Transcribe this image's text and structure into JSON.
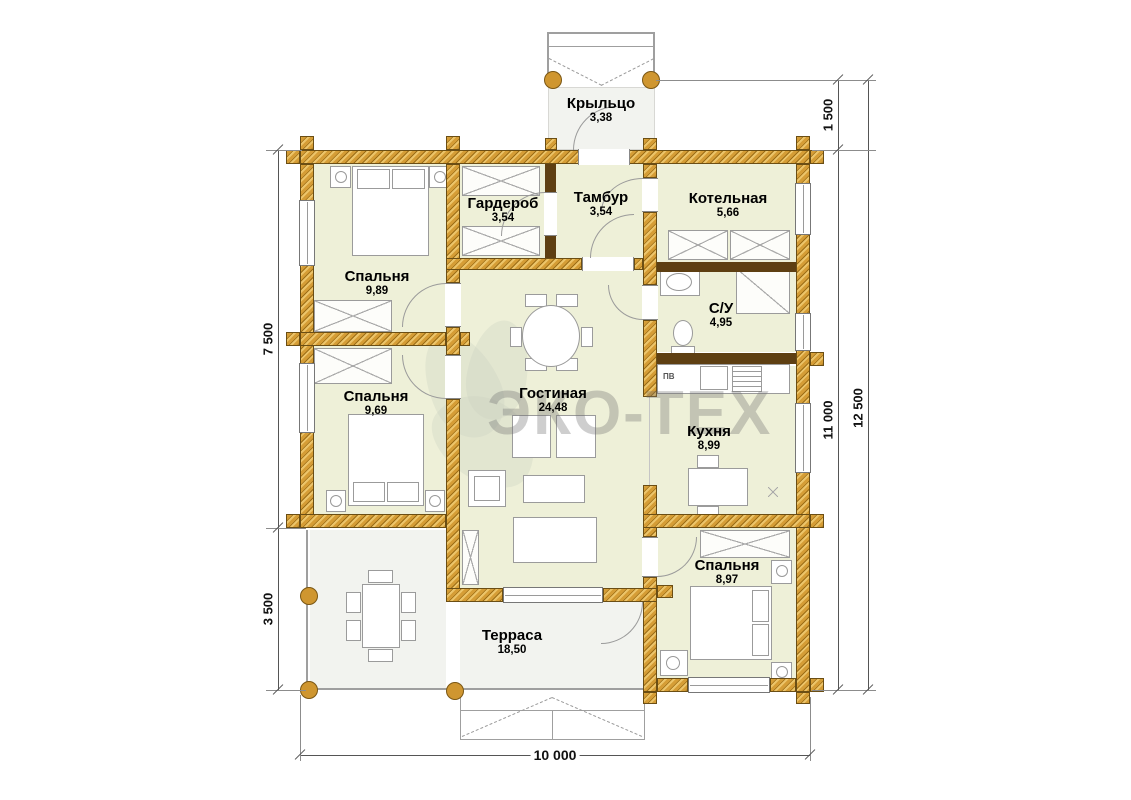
{
  "watermark": {
    "text": "ЭКО-ТЕХ"
  },
  "rooms": {
    "porch": {
      "name": "Крыльцо",
      "area": "3,38"
    },
    "wardrobe": {
      "name": "Гардероб",
      "area": "3,54"
    },
    "vestibule": {
      "name": "Тамбур",
      "area": "3,54"
    },
    "boiler": {
      "name": "Котельная",
      "area": "5,66"
    },
    "bedroom1": {
      "name": "Спальня",
      "area": "9,89"
    },
    "bathroom": {
      "name": "С/У",
      "area": "4,95"
    },
    "bedroom2": {
      "name": "Спальня",
      "area": "9,69"
    },
    "living": {
      "name": "Гостиная",
      "area": "24,48"
    },
    "kitchen": {
      "name": "Кухня",
      "area": "8,99"
    },
    "bedroom3": {
      "name": "Спальня",
      "area": "8,97"
    },
    "terrace": {
      "name": "Терраса",
      "area": "18,50"
    }
  },
  "dimensions": {
    "left_top": "7 500",
    "left_bottom": "3 500",
    "right_porch": "1 500",
    "right_house": "11 000",
    "right_total": "12 500",
    "bottom_width": "10 000"
  },
  "annotations": {
    "vent": "ПВ"
  },
  "colors": {
    "wall": "#d59d36",
    "room_fill": "#eef0d8",
    "terrace_fill": "#f2f3ef",
    "partition": "#5e3f12"
  }
}
